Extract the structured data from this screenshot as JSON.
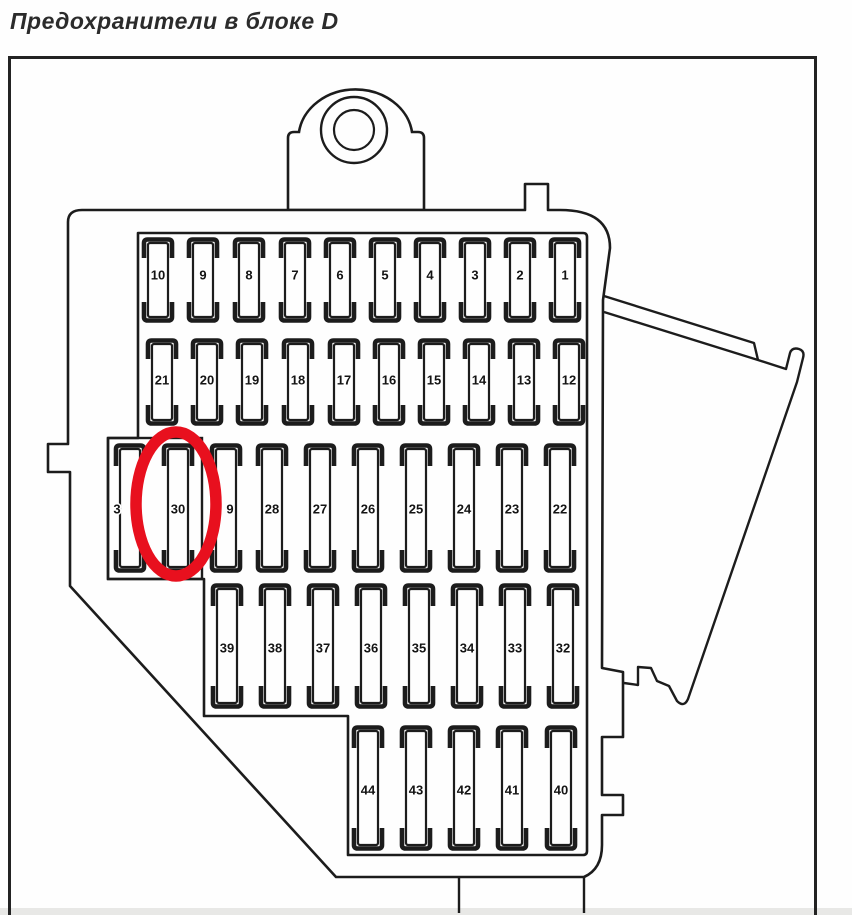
{
  "title": "Предохранители в блоке D",
  "colors": {
    "ink": "#1c1c1c",
    "paper": "#ffffff",
    "highlight_red": "#e8101e"
  },
  "highlight": {
    "fuse_label": "30",
    "shape": "red-oval"
  },
  "diagram": {
    "name": "fuse-box-block-D",
    "rows": [
      {
        "labels": [
          "10",
          "9",
          "8",
          "7",
          "6",
          "5",
          "4",
          "3",
          "2",
          "1"
        ]
      },
      {
        "labels": [
          "21",
          "20",
          "19",
          "18",
          "17",
          "16",
          "15",
          "14",
          "13",
          "12"
        ]
      },
      {
        "labels": [
          "3",
          "30",
          "9",
          "28",
          "27",
          "26",
          "25",
          "24",
          "23",
          "22"
        ]
      },
      {
        "labels": [
          "39",
          "38",
          "37",
          "36",
          "35",
          "34",
          "33",
          "32"
        ]
      },
      {
        "labels": [
          "44",
          "43",
          "42",
          "41",
          "40"
        ]
      }
    ]
  }
}
